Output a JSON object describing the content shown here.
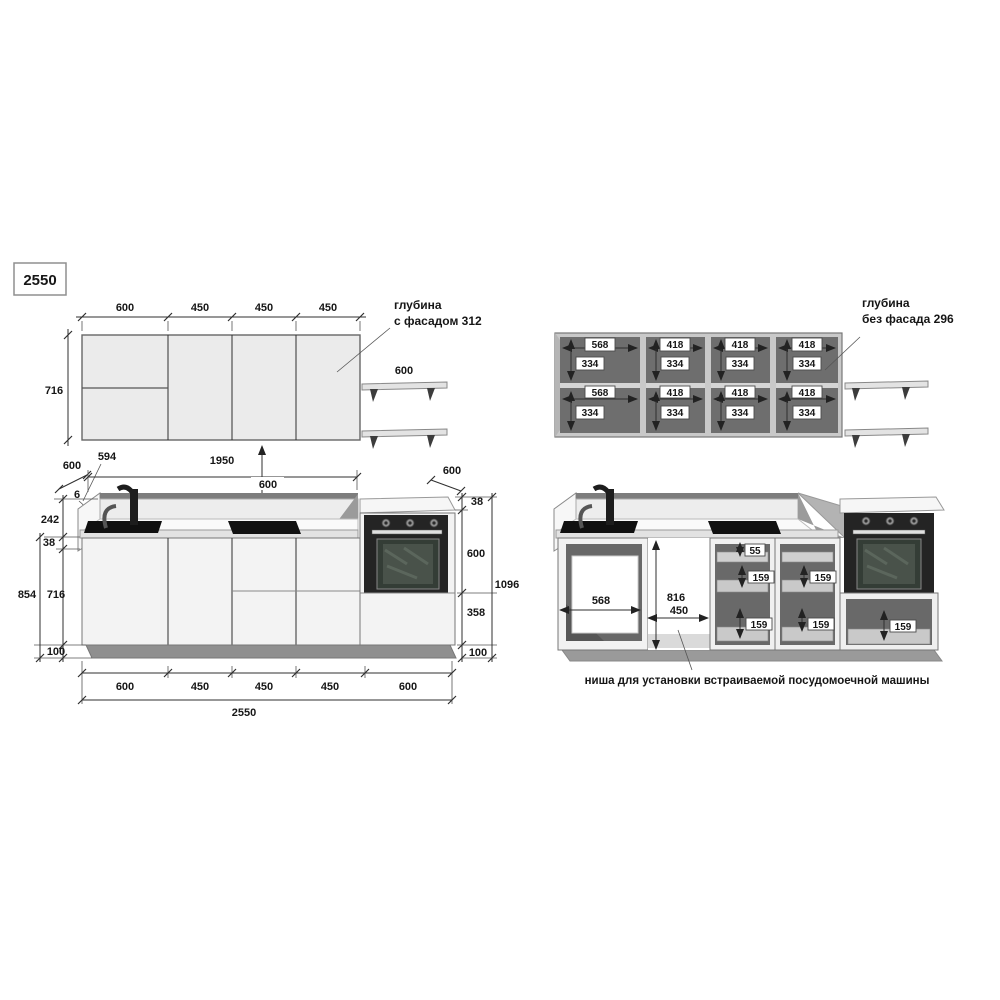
{
  "title_box": {
    "value": "2550"
  },
  "upper_front": {
    "top_dims": [
      "600",
      "450",
      "450",
      "450"
    ],
    "height": "716",
    "shelf_width": "600",
    "depth_note_line1": "глубина",
    "depth_note_line2": "с фасадом 312"
  },
  "upper_open": {
    "depth_note_line1": "глубина",
    "depth_note_line2": "без фасада 296",
    "sections": [
      {
        "w_top": "568",
        "h_top": "334",
        "w_bot": "568",
        "h_bot": "334"
      },
      {
        "w_top": "418",
        "h_top": "334",
        "w_bot": "418",
        "h_bot": "334"
      },
      {
        "w_top": "418",
        "h_top": "334",
        "w_bot": "418",
        "h_bot": "334"
      },
      {
        "w_top": "418",
        "h_top": "334",
        "w_bot": "418",
        "h_bot": "334"
      }
    ]
  },
  "base_front": {
    "top": {
      "left_depth": "600",
      "left_offset": "594",
      "run_width": "1950",
      "upper_gap": "600",
      "right_depth": "600",
      "panel": "6"
    },
    "left": {
      "splash": "242",
      "counter": "38",
      "total": "854",
      "cabinet": "716",
      "plinth": "100"
    },
    "right": {
      "counter": "38",
      "oven": "600",
      "drawer": "358",
      "plinth": "100",
      "total": "1096"
    },
    "bottom_dims": [
      "600",
      "450",
      "450",
      "450",
      "600"
    ],
    "total_width": "2550"
  },
  "base_open": {
    "sink_inner_width": "568",
    "niche_height": "816",
    "niche_width": "450",
    "cab1_drawers": [
      "55",
      "159",
      "159"
    ],
    "cab2_drawers": [
      "159",
      "159"
    ],
    "oven_drawer": "159",
    "niche_note": "ниша для установки встраиваемой посудомоечной машины"
  }
}
